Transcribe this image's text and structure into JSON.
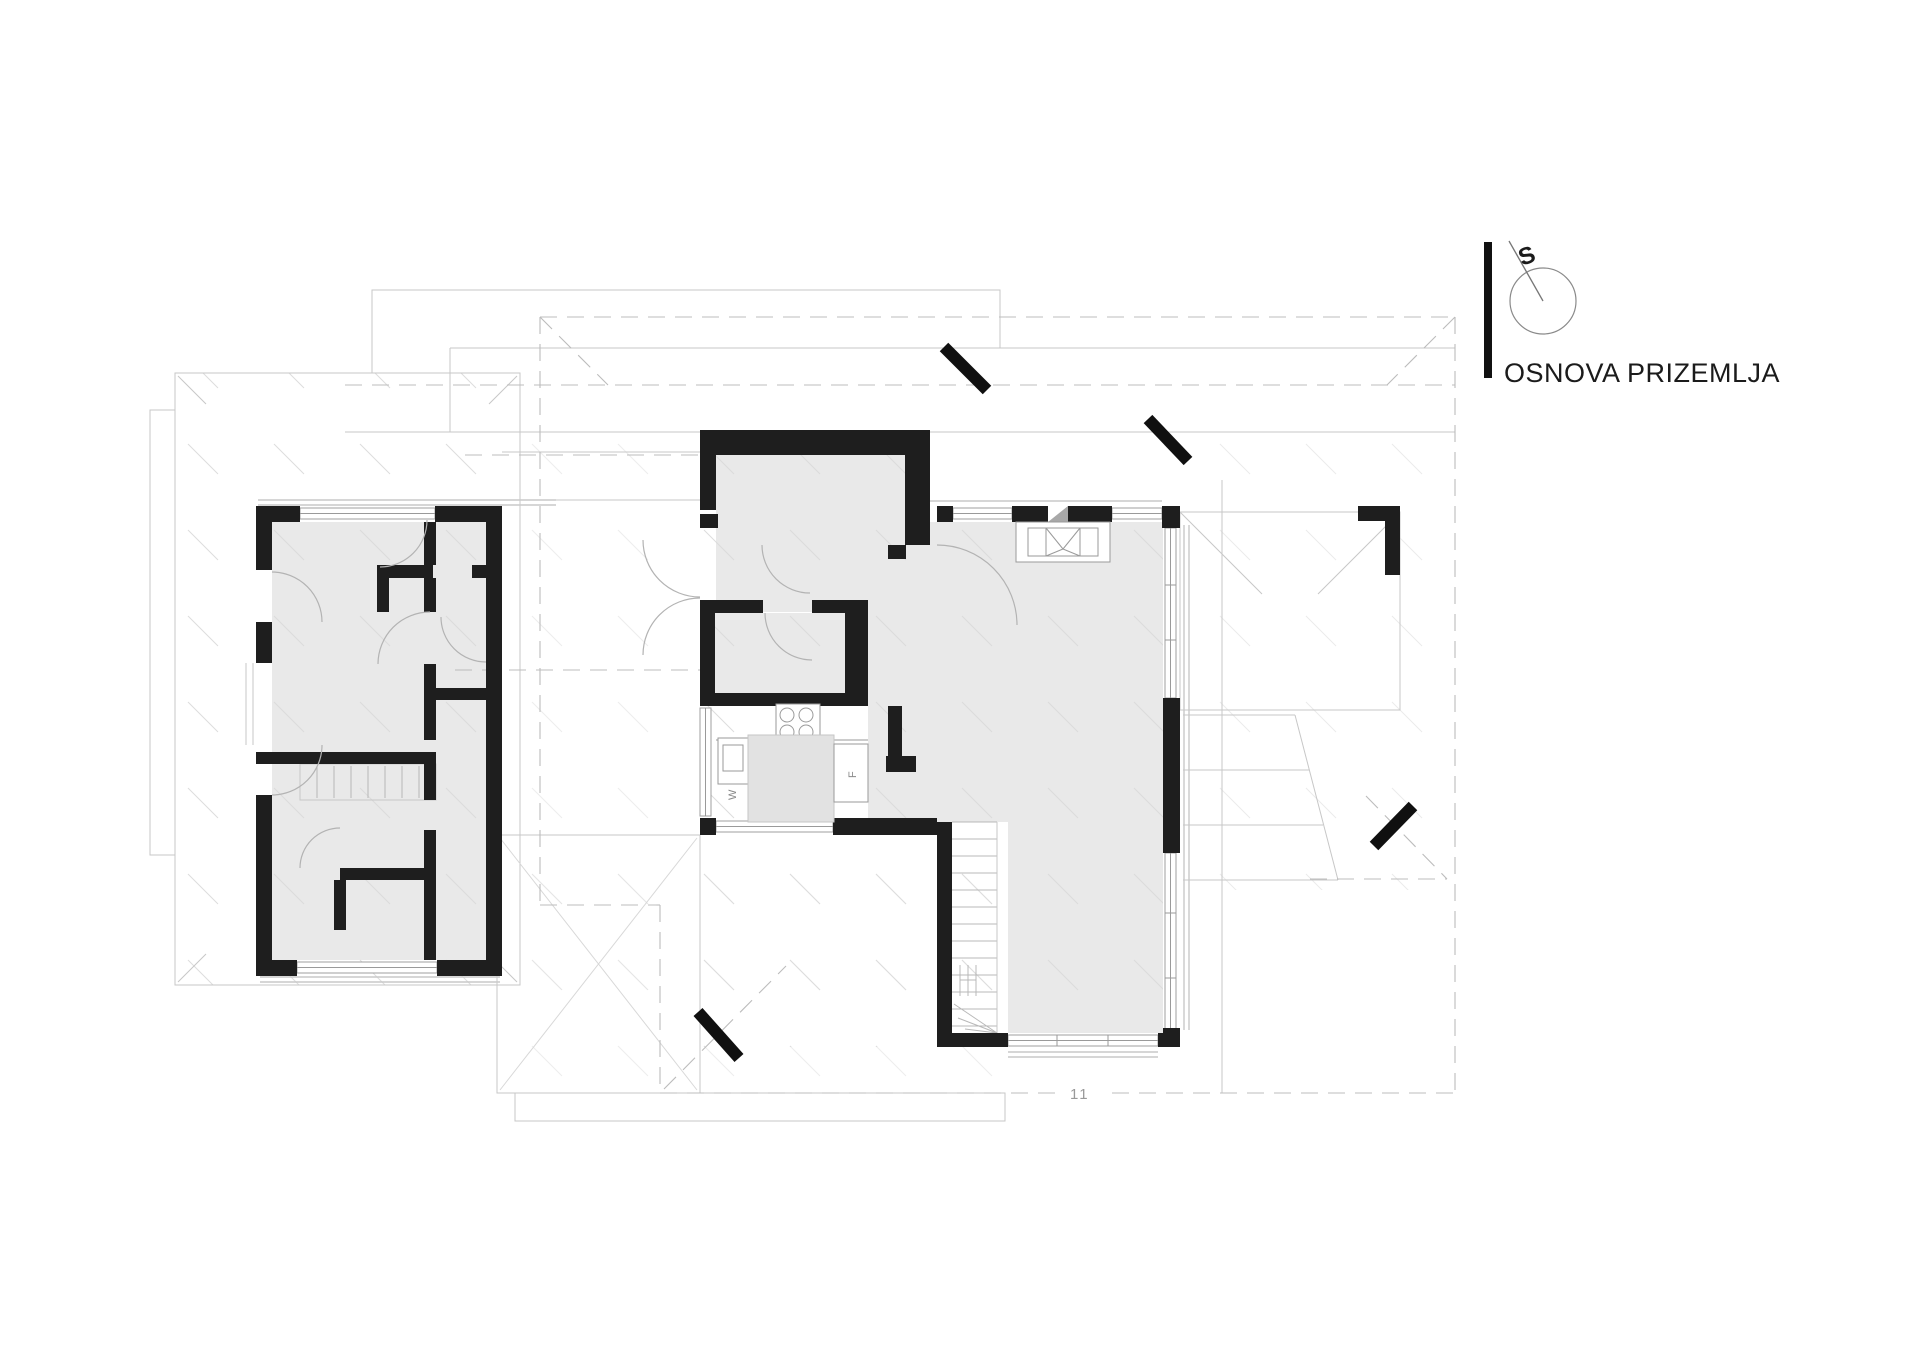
{
  "drawing": {
    "title": "OSNOVA PRIZEMLJA",
    "north_label": "S",
    "section_label": "11",
    "appliance_labels": {
      "washer": "W",
      "fridge": "F"
    }
  },
  "icons": {
    "north_indicator": "north-arrow-circle-icon",
    "section_markers": "section-cut-marker"
  },
  "colors": {
    "wall": "#1e1e1e",
    "room-fill": "#e9e9e9",
    "island-fill": "#e2e2e2",
    "outline": "#c7c7c7",
    "dashed": "#bcbcbc",
    "tick": "#d9d9d9",
    "fixture": "#9a9a9a",
    "arc": "#b3b3b3",
    "text": "#1b1b1b",
    "muted": "#999999"
  }
}
